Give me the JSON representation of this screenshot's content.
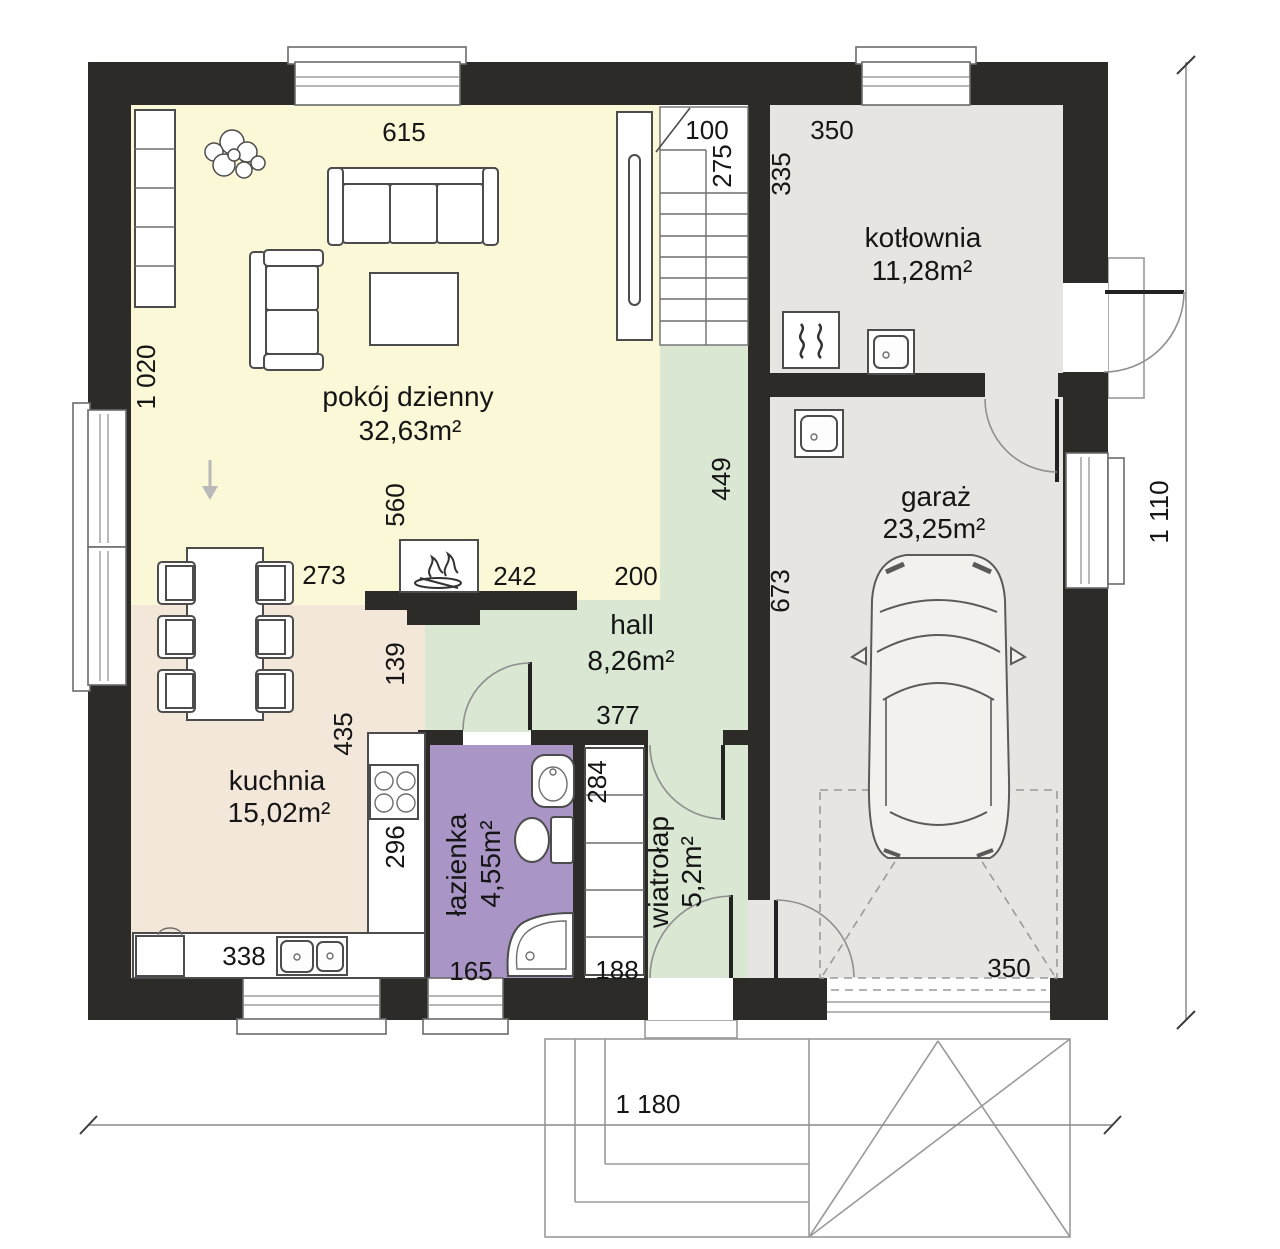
{
  "title": "Rzut parteru – plan domu",
  "rooms": {
    "living": {
      "name": "pokój dzienny",
      "area": "32,63m²",
      "color": "#fbf8d7"
    },
    "kitchen": {
      "name": "kuchnia",
      "area": "15,02m²",
      "color": "#f3e7da"
    },
    "hall": {
      "name": "hall",
      "area": "8,26m²",
      "color": "#d9e7d3"
    },
    "bath": {
      "name": "łazienka",
      "area": "4,55m²",
      "color": "#a995c6"
    },
    "vestibule": {
      "name": "wiatrołap",
      "area": "5,2m²",
      "color": "#d9e7d3"
    },
    "boiler": {
      "name": "kotłownia",
      "area": "11,28m²",
      "color": "#e6e5e2"
    },
    "garage": {
      "name": "garaż",
      "area": "23,25m²",
      "color": "#e6e5e2"
    }
  },
  "dims": {
    "living_width": "615",
    "stair_width": "100",
    "stair_depth": "275",
    "boiler_width": "350",
    "boiler_depth": "335",
    "living_height": "1 020",
    "hall_right": "449",
    "garage_left": "673",
    "fireplace_offset": "560",
    "dining": "273",
    "fireplace_right": "242",
    "hall_top": "200",
    "kitchen_hall": "139",
    "kitchen_depth": "435",
    "counter": "296",
    "hall_width": "377",
    "closet_upper": "284",
    "closet_lower": "188",
    "bath_bottom": "165",
    "kitchen_bottom": "338",
    "garage_door": "350",
    "total_width": "1 180",
    "total_height": "1 110"
  },
  "colors": {
    "wall": "#2d2b28",
    "white": "#ffffff",
    "floor_neutral": "#e6e5e2"
  }
}
